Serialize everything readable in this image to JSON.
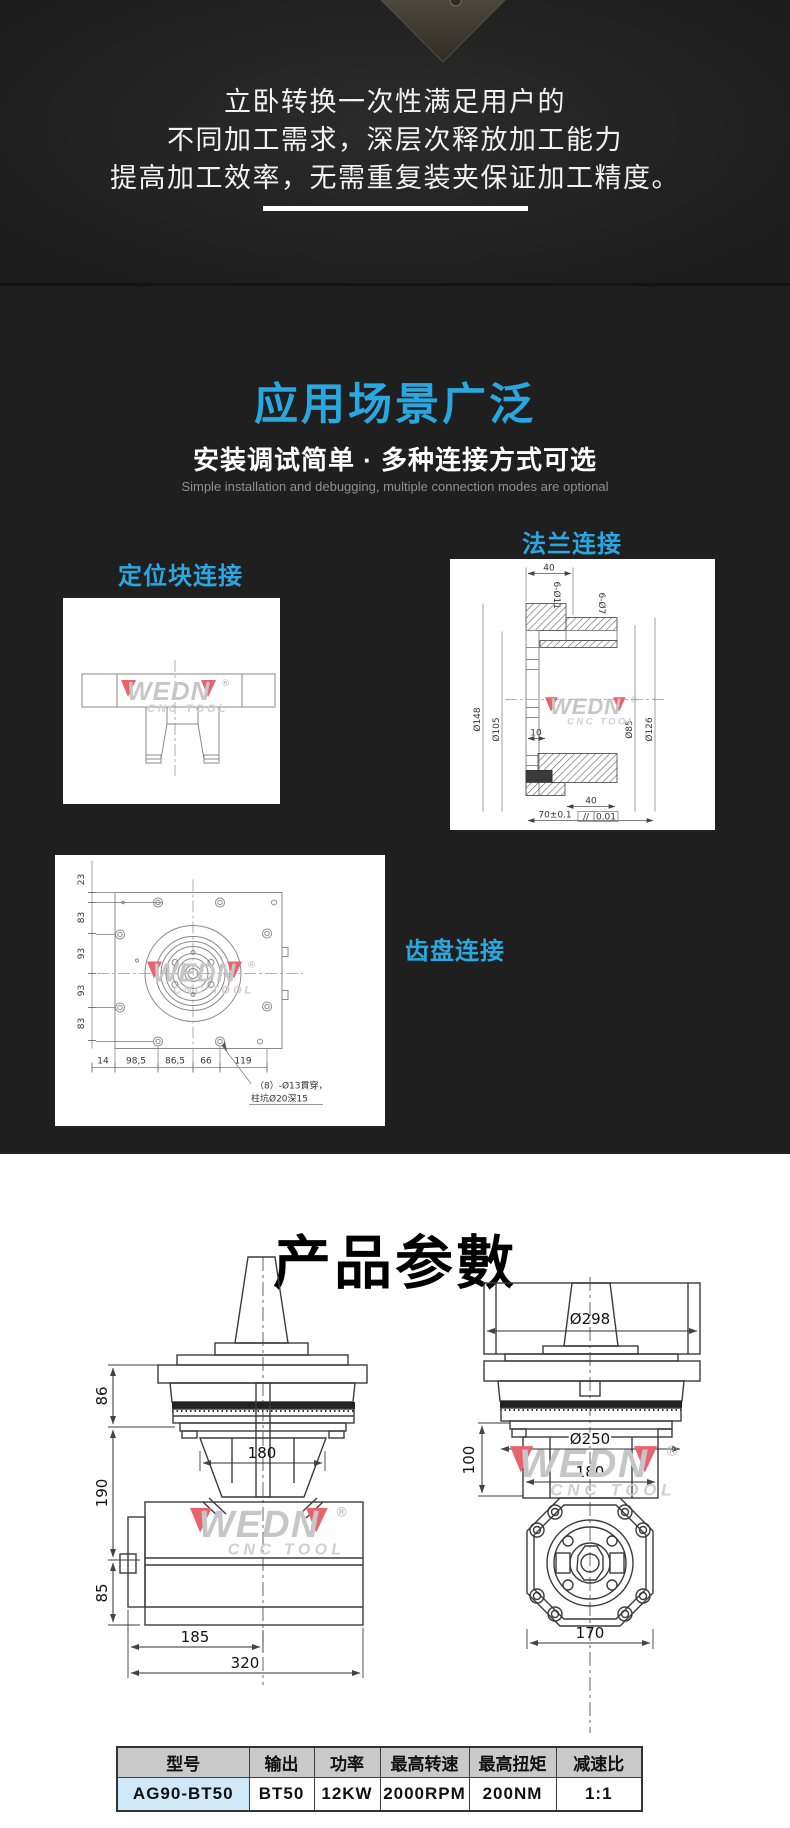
{
  "colors": {
    "accent": "#29a7e0",
    "dark_bg": "#1f1f20",
    "table_header_bg": "#c9c9c9",
    "table_model_bg": "#cfe9f8",
    "watermark_red": "#e03a40"
  },
  "hero": {
    "line1": "立卧转换一次性满足用户的",
    "line2": "不同加工需求，深层次释放加工能力",
    "line3": "提高加工效率，无需重复装夹保证加工精度。"
  },
  "scenarios": {
    "title": "应用场景广泛",
    "subtitle": "安装调试简单 · 多种连接方式可选",
    "subtitle_en": "Simple installation and debugging, multiple connection modes are optional",
    "block_label": "定位块连接",
    "flange_label": "法兰连接",
    "gear_label": "齿盘连接"
  },
  "flange_drawing": {
    "dim_top": "40",
    "dim_holes_a": "6-Ø11",
    "dim_holes_b": "6-Ø7",
    "dim_d148": "Ø148",
    "dim_d105": "Ø105",
    "dim_d85": "Ø85",
    "dim_d126": "Ø126",
    "dim_10": "10",
    "dim_bottom": "40",
    "dim_total": "70±0.1",
    "tol_sym": "//",
    "dim_tol": "0.01"
  },
  "gear_drawing": {
    "left_dims": [
      "23",
      "83",
      "93",
      "93",
      "83"
    ],
    "bottom_dims": [
      "14",
      "98,5",
      "86,5",
      "66",
      "119"
    ],
    "note1": "（8）-Ø13貫穿，",
    "note2": "柱坑Ø20深15"
  },
  "params": {
    "title": "产品参數"
  },
  "side_view": {
    "d86": "86",
    "d190": "190",
    "d85": "85",
    "d180": "180",
    "d185": "185",
    "d320": "320"
  },
  "front_view": {
    "d298": "Ø298",
    "d100": "100",
    "d250": "Ø250",
    "d180": "180",
    "d170": "170"
  },
  "watermark": {
    "brand": "WEDN",
    "sub": "CNC TOOL",
    "reg": "®"
  },
  "spec_table": {
    "headers": [
      "型号",
      "输出",
      "功率",
      "最高转速",
      "最高扭矩",
      "减速比"
    ],
    "row": [
      "AG90-BT50",
      "BT50",
      "12KW",
      "2000RPM",
      "200NM",
      "1:1"
    ]
  }
}
